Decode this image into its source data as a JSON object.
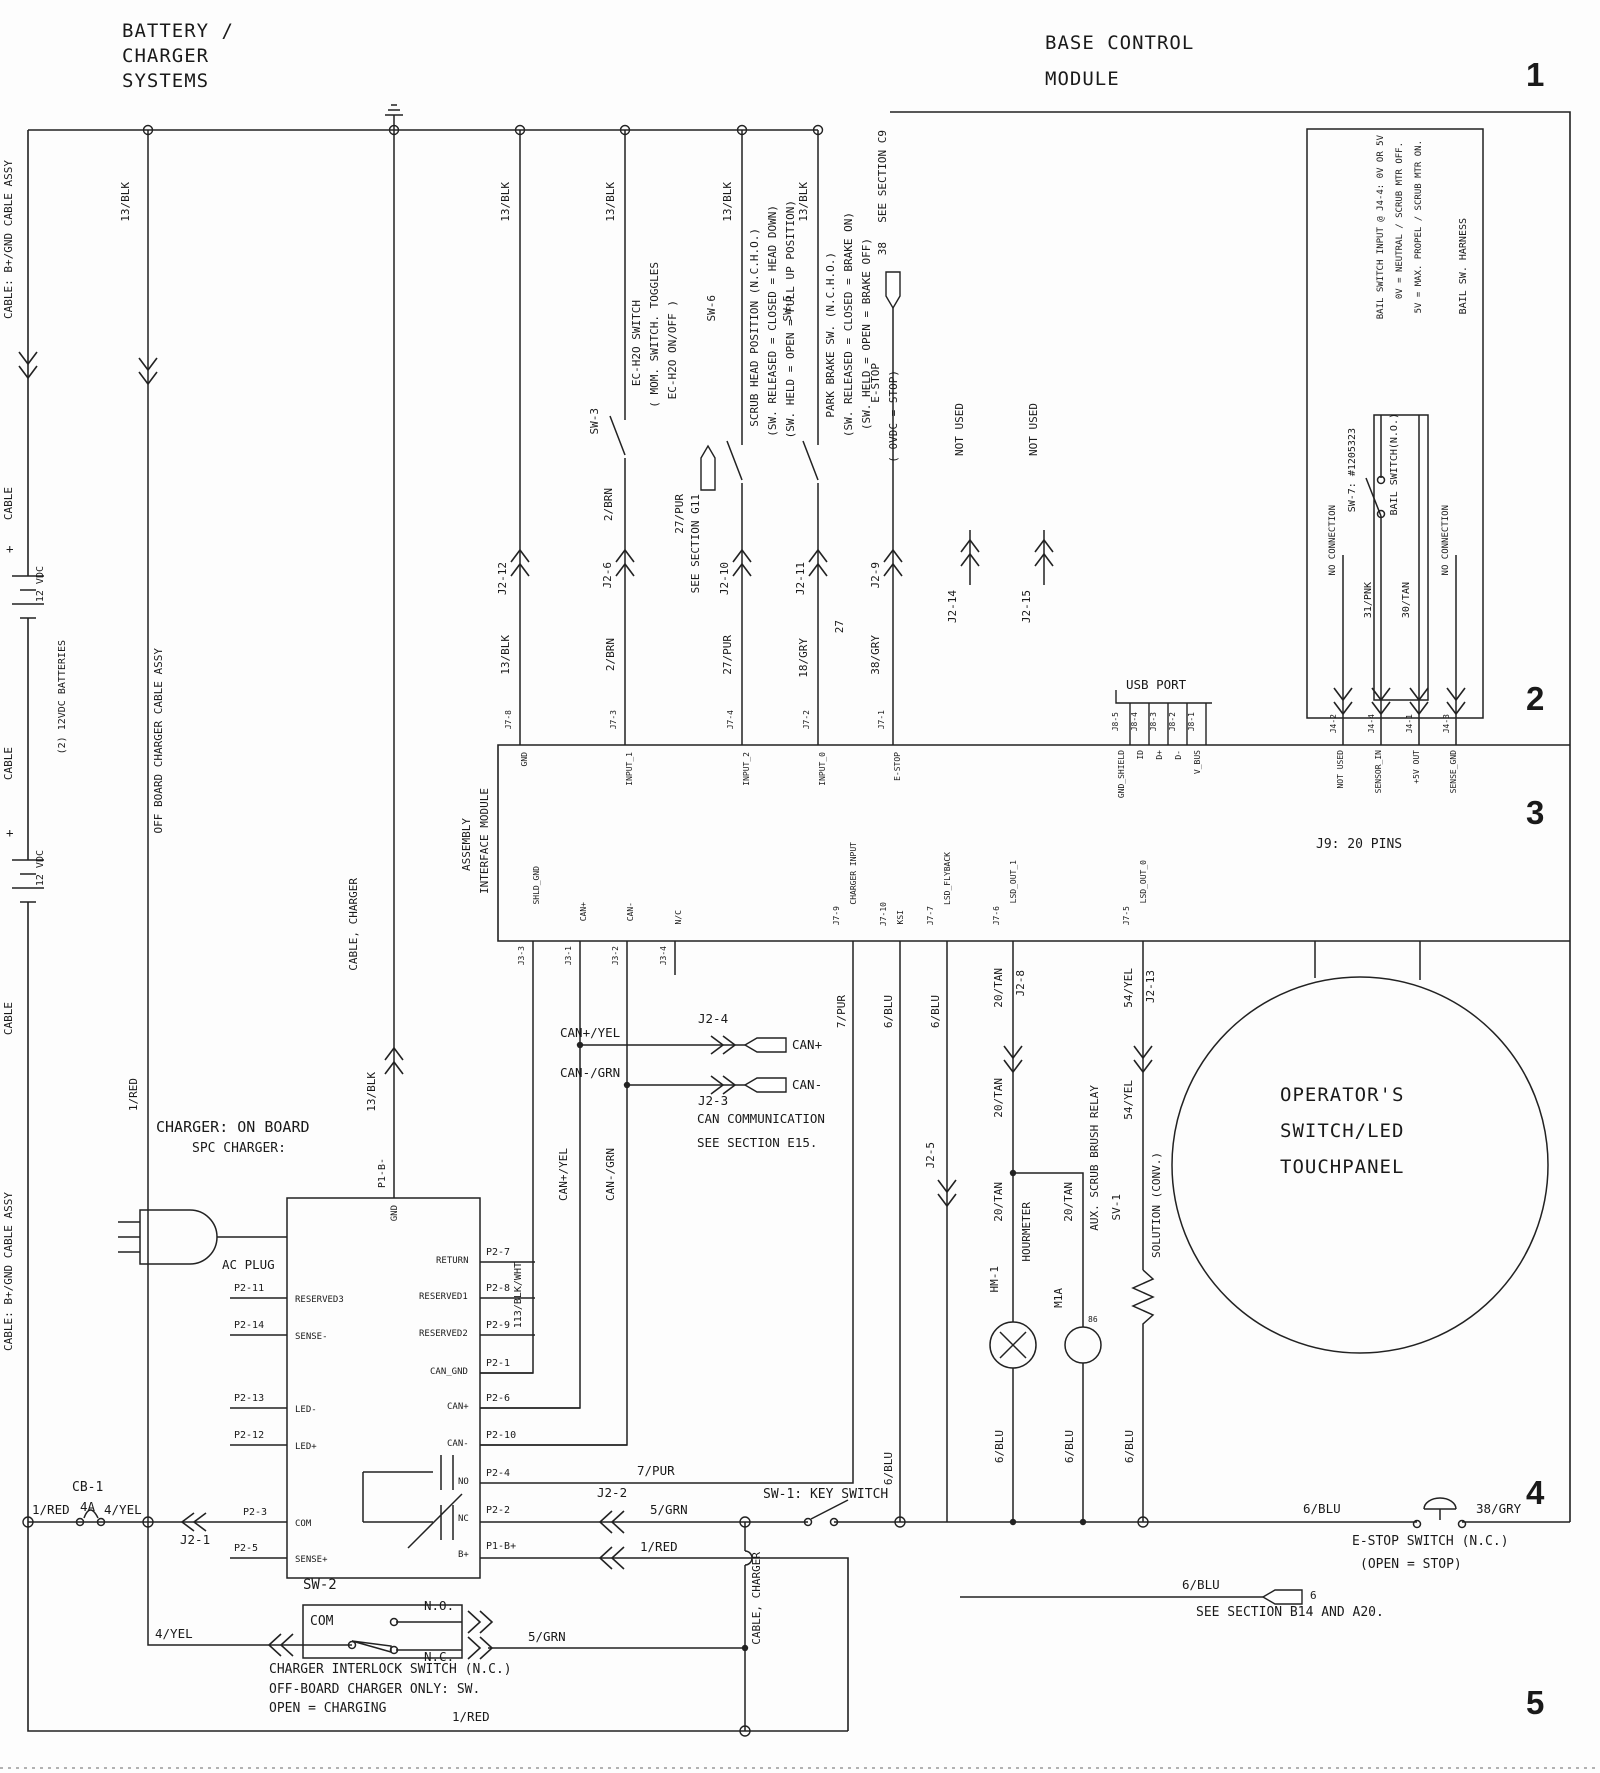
{
  "titles": {
    "bat1": "BATTERY /",
    "bat2": "CHARGER",
    "bat3": "SYSTEMS",
    "bcm1": "BASE CONTROL",
    "bcm2": "MODULE"
  },
  "markers": {
    "r1": "1",
    "r2": "2",
    "r3": "3",
    "r4": "4",
    "r5": "5"
  },
  "wires": {
    "blk13": "13/BLK",
    "brn2": "2/BRN",
    "pur27": "27/PUR",
    "gry18": "18/GRY",
    "gry38": "38/GRY",
    "pnk31": "31/PNK",
    "tan30": "30/TAN",
    "pur7": "7/PUR",
    "blu6": "6/BLU",
    "tan20": "20/TAN",
    "yel54": "54/YEL",
    "red1": "1/RED",
    "yel4": "4/YEL",
    "grn5": "5/GRN",
    "blkwht113": "113/BLK/WHT",
    "canpyel": "CAN+/YEL",
    "canngrn": "CAN-/GRN",
    "w27": "27"
  },
  "left": {
    "cable_assy": "CABLE: B+/GND CABLE ASSY",
    "cable": "CABLE",
    "batteries": "(2) 12VDC BATTERIES",
    "vdc": "12 VDC",
    "offboard": "OFF BOARD CHARGER CABLE ASSY",
    "plus": "+",
    "cable_charger": "CABLE, CHARGER"
  },
  "conn": {
    "j2_12": "J2-12",
    "j2_6": "J2-6",
    "j2_10": "J2-10",
    "j2_11": "J2-11",
    "j2_9": "J2-9",
    "j2_14": "J2-14",
    "j2_15": "J2-15",
    "j2_8": "J2-8",
    "j2_13": "J2-13",
    "j2_5": "J2-5",
    "j2_4": "J2-4",
    "j2_3": "J2-3",
    "j2_2": "J2-2",
    "j2_1": "J2-1",
    "not_used": "NOT USED"
  },
  "sw": {
    "sw3": {
      "id": "SW-3",
      "l1": "EC-H2O SWITCH",
      "l2": "( MOM. SWITCH. TOGGLES",
      "l3": "EC-H2O ON/OFF )"
    },
    "sw6": {
      "id": "SW-6",
      "l1": "SCRUB HEAD POSITION (N.C.H.O.)",
      "l2": "(SW. RELEASED = CLOSED = HEAD DOWN)",
      "l3": "(SW. HELD = OPEN = FULL UP POSITION)"
    },
    "sw5": {
      "id": "SW-5",
      "l1": "PARK BRAKE SW. (N.C.H.O.)",
      "l2": "(SW. RELEASED = CLOSED = BRAKE ON)",
      "l3": "(SW. HELD = OPEN = BRAKE OFF)"
    },
    "sw1": "SW-1: KEY SWITCH",
    "sw2": {
      "id": "SW-2",
      "com": "COM",
      "no": "N.O.",
      "nc": "N.C.",
      "d1": "CHARGER INTERLOCK SWITCH (N.C.)",
      "d2": "OFF-BOARD CHARGER ONLY:  SW.",
      "d3": "OPEN = CHARGING"
    },
    "sw7": {
      "id": "SW-7: #1205323",
      "name": "BAIL SWITCH(N.O.)"
    },
    "estop_col": {
      "name": "E-STOP",
      "state": "( 0VDC = STOP)"
    },
    "estop_main": {
      "name": "E-STOP SWITCH (N.C.)",
      "state": "(OPEN = STOP)"
    }
  },
  "flags": {
    "g11": "SEE SECTION G11",
    "g11wire": "27/PUR",
    "c9": "SEE SECTION C9",
    "c9num": "38",
    "can1": "CAN COMMUNICATION",
    "can2": "SEE SECTION E15.",
    "b14": "SEE SECTION B14 AND A20.",
    "b14num": "6",
    "canp": "CAN+",
    "cann": "CAN-"
  },
  "bail": {
    "l1": "BAIL SWITCH INPUT @ J4-4: 0V OR 5V",
    "l2": "0V = NEUTRAL / SCRUB MTR OFF.",
    "l3": "5V = MAX. PROPEL / SCRUB MTR ON.",
    "harness": "BAIL SW. HARNESS",
    "no_conn": "NO CONNECTION",
    "j4_2": "J4-2",
    "j4_4": "J4-4",
    "j4_1": "J4-1",
    "j4_3": "J4-3",
    "n1": "NOT USED",
    "n2": "SENSOR_IN",
    "n3": "+5V OUT",
    "n4": "SENSE_GND"
  },
  "usb": {
    "title": "USB PORT",
    "j8_5": "J8-5",
    "j8_4": "J8-4",
    "j8_3": "J8-3",
    "j8_2": "J8-2",
    "j8_1": "J8-1",
    "n1": "GND_SHIELD",
    "n2": "ID",
    "n3": "D+",
    "n4": "D-",
    "n5": "V_BUS"
  },
  "module": {
    "n1": "ASSEMBLY",
    "n2": "INTERFACE MODULE",
    "j7_8": "J7-8",
    "gnd": "GND",
    "j7_3": "J7-3",
    "in1": "INPUT_1",
    "j7_4": "J7-4",
    "in2": "INPUT_2",
    "j7_2": "J7-2",
    "in0": "INPUT_0",
    "j7_1": "J7-1",
    "estop": "E-STOP",
    "j3_3": "J3-3",
    "shld": "SHLD_GND",
    "j3_1": "J3-1",
    "canp": "CAN+",
    "j3_2": "J3-2",
    "cann": "CAN-",
    "j3_4": "J3-4",
    "nc": "N/C",
    "j7_9": "J7-9",
    "chg": "CHARGER INPUT",
    "j7_10": "J7-10",
    "ksi": "KSI",
    "j7_7": "J7-7",
    "fly": "LSD_FLYBACK",
    "j7_6": "J7-6",
    "out1": "LSD_OUT_1",
    "j7_5": "J7-5",
    "out0": "LSD_OUT_0"
  },
  "charger": {
    "t1": "CHARGER: ON BOARD",
    "t2": "SPC CHARGER:",
    "plug": "AC PLUG",
    "p2_11": "P2-11",
    "res3": "RESERVED3",
    "p2_14": "P2-14",
    "sm": "SENSE-",
    "p2_13": "P2-13",
    "ledm": "LED-",
    "p2_12": "P2-12",
    "ledp": "LED+",
    "p2_3": "P2-3",
    "com": "COM",
    "p2_5": "P2-5",
    "sp": "SENSE+",
    "p2_7": "P2-7",
    "ret": "RETURN",
    "p2_8": "P2-8",
    "res1": "RESERVED1",
    "p2_9": "P2-9",
    "res2": "RESERVED2",
    "p2_1": "P2-1",
    "cgnd": "CAN_GND",
    "p2_6": "P2-6",
    "canp": "CAN+",
    "p2_10": "P2-10",
    "cann": "CAN-",
    "p2_4": "P2-4",
    "no": "NO",
    "p2_2": "P2-2",
    "nc": "NC",
    "p1bp": "P1-B+",
    "bp": "B+",
    "p1bm": "P1-B-",
    "gnd": "GND"
  },
  "loads": {
    "hm": "HM-1",
    "hm_name": "HOURMETER",
    "m1a": "M1A",
    "relay": "AUX. SCRUB BRUSH RELAY",
    "pin86": "86",
    "sv": "SV-1",
    "sv_name": "SOLUTION (CONV.)"
  },
  "panel": {
    "j9": "J9: 20 PINS",
    "l1": "OPERATOR'S",
    "l2": "SWITCH/LED",
    "l3": "TOUCHPANEL"
  },
  "cb": {
    "id": "CB-1",
    "amps": "4A"
  }
}
